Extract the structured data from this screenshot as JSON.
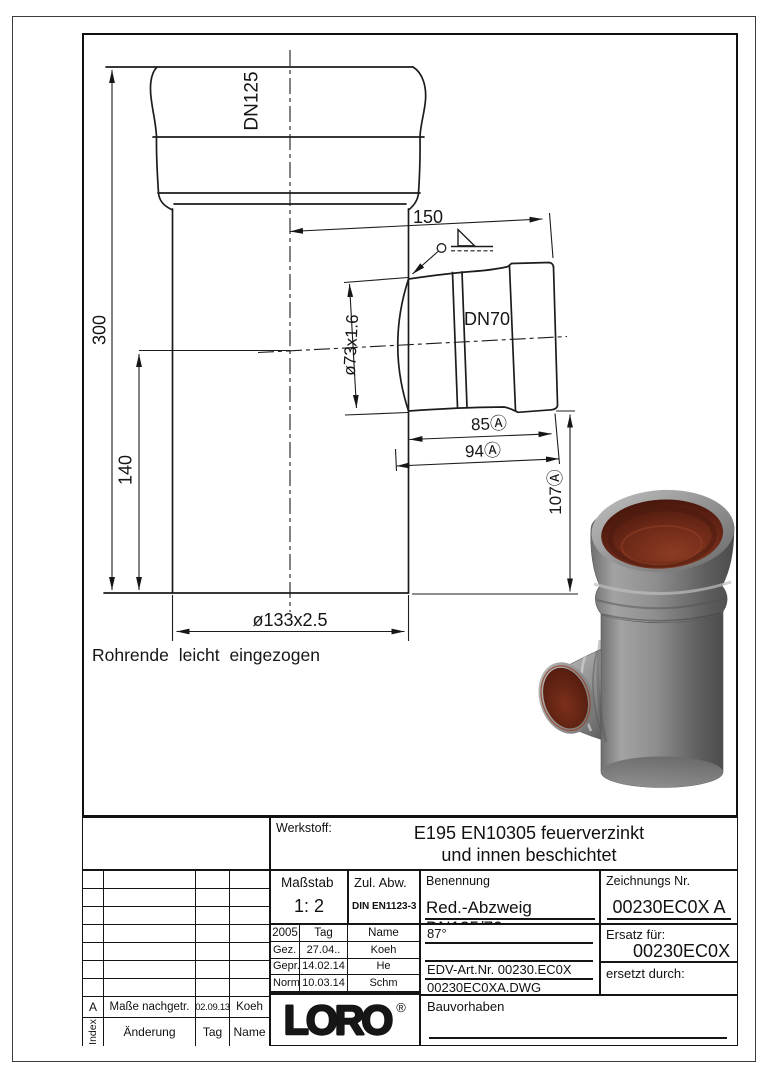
{
  "drawing": {
    "labels": {
      "dn_main": "DN125",
      "dn_branch": "DN70"
    },
    "dims": {
      "total_height": "300",
      "branch_center": "140",
      "main_dia": "ø133x2.5",
      "branch_dia": "ø73x1.6",
      "branch_len": "150",
      "len_85": "85Ⓐ",
      "len_94": "94Ⓐ",
      "len_107": "107Ⓐ"
    },
    "note": "Rohrende leicht eingezogen"
  },
  "title_block": {
    "werkstoff_label": "Werkstoff:",
    "werkstoff_line1": "E195 EN10305 feuerverzinkt",
    "werkstoff_line2": "und innen beschichtet",
    "massstab_label": "Maßstab",
    "massstab_value": "1: 2",
    "zul_abw_label": "Zul. Abw.",
    "zul_abw_value": "DIN EN1123-3",
    "benennung_label": "Benennung",
    "benennung_value": "Red.-Abzweig DN125/70",
    "zeichnung_label": "Zeichnungs Nr.",
    "zeichnung_value": "00230EC0X A",
    "angle_value": "87°",
    "edv_value": "EDV-Art.Nr. 00230.EC0X",
    "dwg_value": "00230EC0XA.DWG",
    "ersatz_label": "Ersatz für:",
    "ersatz_value": "00230EC0X",
    "ersetzt_label": "ersetzt durch:",
    "bauvorhaben_label": "Bauvorhaben",
    "year": "2005",
    "tag_label": "Tag",
    "name_label": "Name",
    "rows": [
      {
        "label": "Gez.",
        "tag": "27.04..",
        "name": "Koeh"
      },
      {
        "label": "Gepr.",
        "tag": "14.02.14",
        "name": "He"
      },
      {
        "label": "Norm.",
        "tag": "10.03.14",
        "name": "Schm"
      }
    ],
    "logo_text": "LORO",
    "logo_reg": "®",
    "revision": {
      "index": "A",
      "change": "Maße nachgetr.",
      "date": "02.09.13",
      "name": "Koeh"
    },
    "revision_header": {
      "index": "Index",
      "change": "Änderung",
      "date": "Tag",
      "name": "Name"
    }
  },
  "colors": {
    "line": "#1c1c1c",
    "pipe_gray": "#8f8f8f",
    "bore_brown": "#6c2817"
  }
}
